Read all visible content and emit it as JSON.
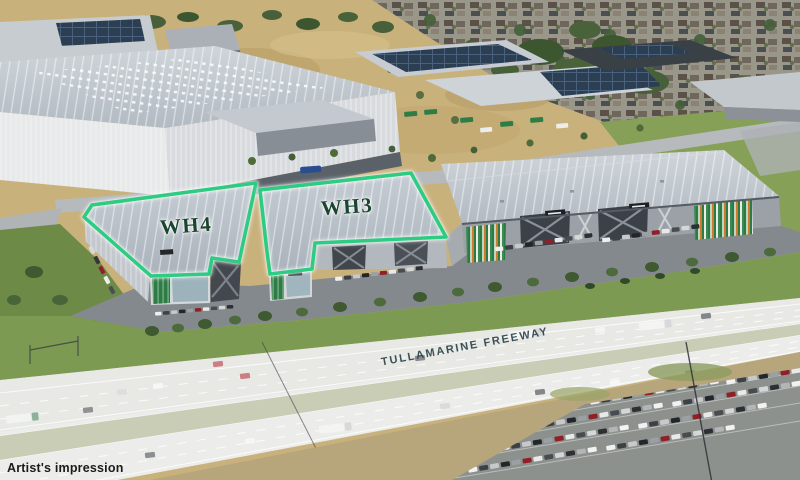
{
  "annotations": {
    "wh4": {
      "label": "WH4",
      "outline_points": "84,217 92,205 256,183 239,262 212,258 209,274 151,276"
    },
    "wh3": {
      "label": "WH3",
      "outline_points": "260,190 411,173 446,237 315,243 312,269 270,274 267,252"
    },
    "freeway_label": "TULLAMARINE FREEWAY",
    "disclaimer": "Artist's impression"
  },
  "colors": {
    "outline_green": "#2ecb82",
    "wh_label": "#1a4631",
    "freeway_label": "#2c444c",
    "disclaimer": "#1b1b1b"
  }
}
